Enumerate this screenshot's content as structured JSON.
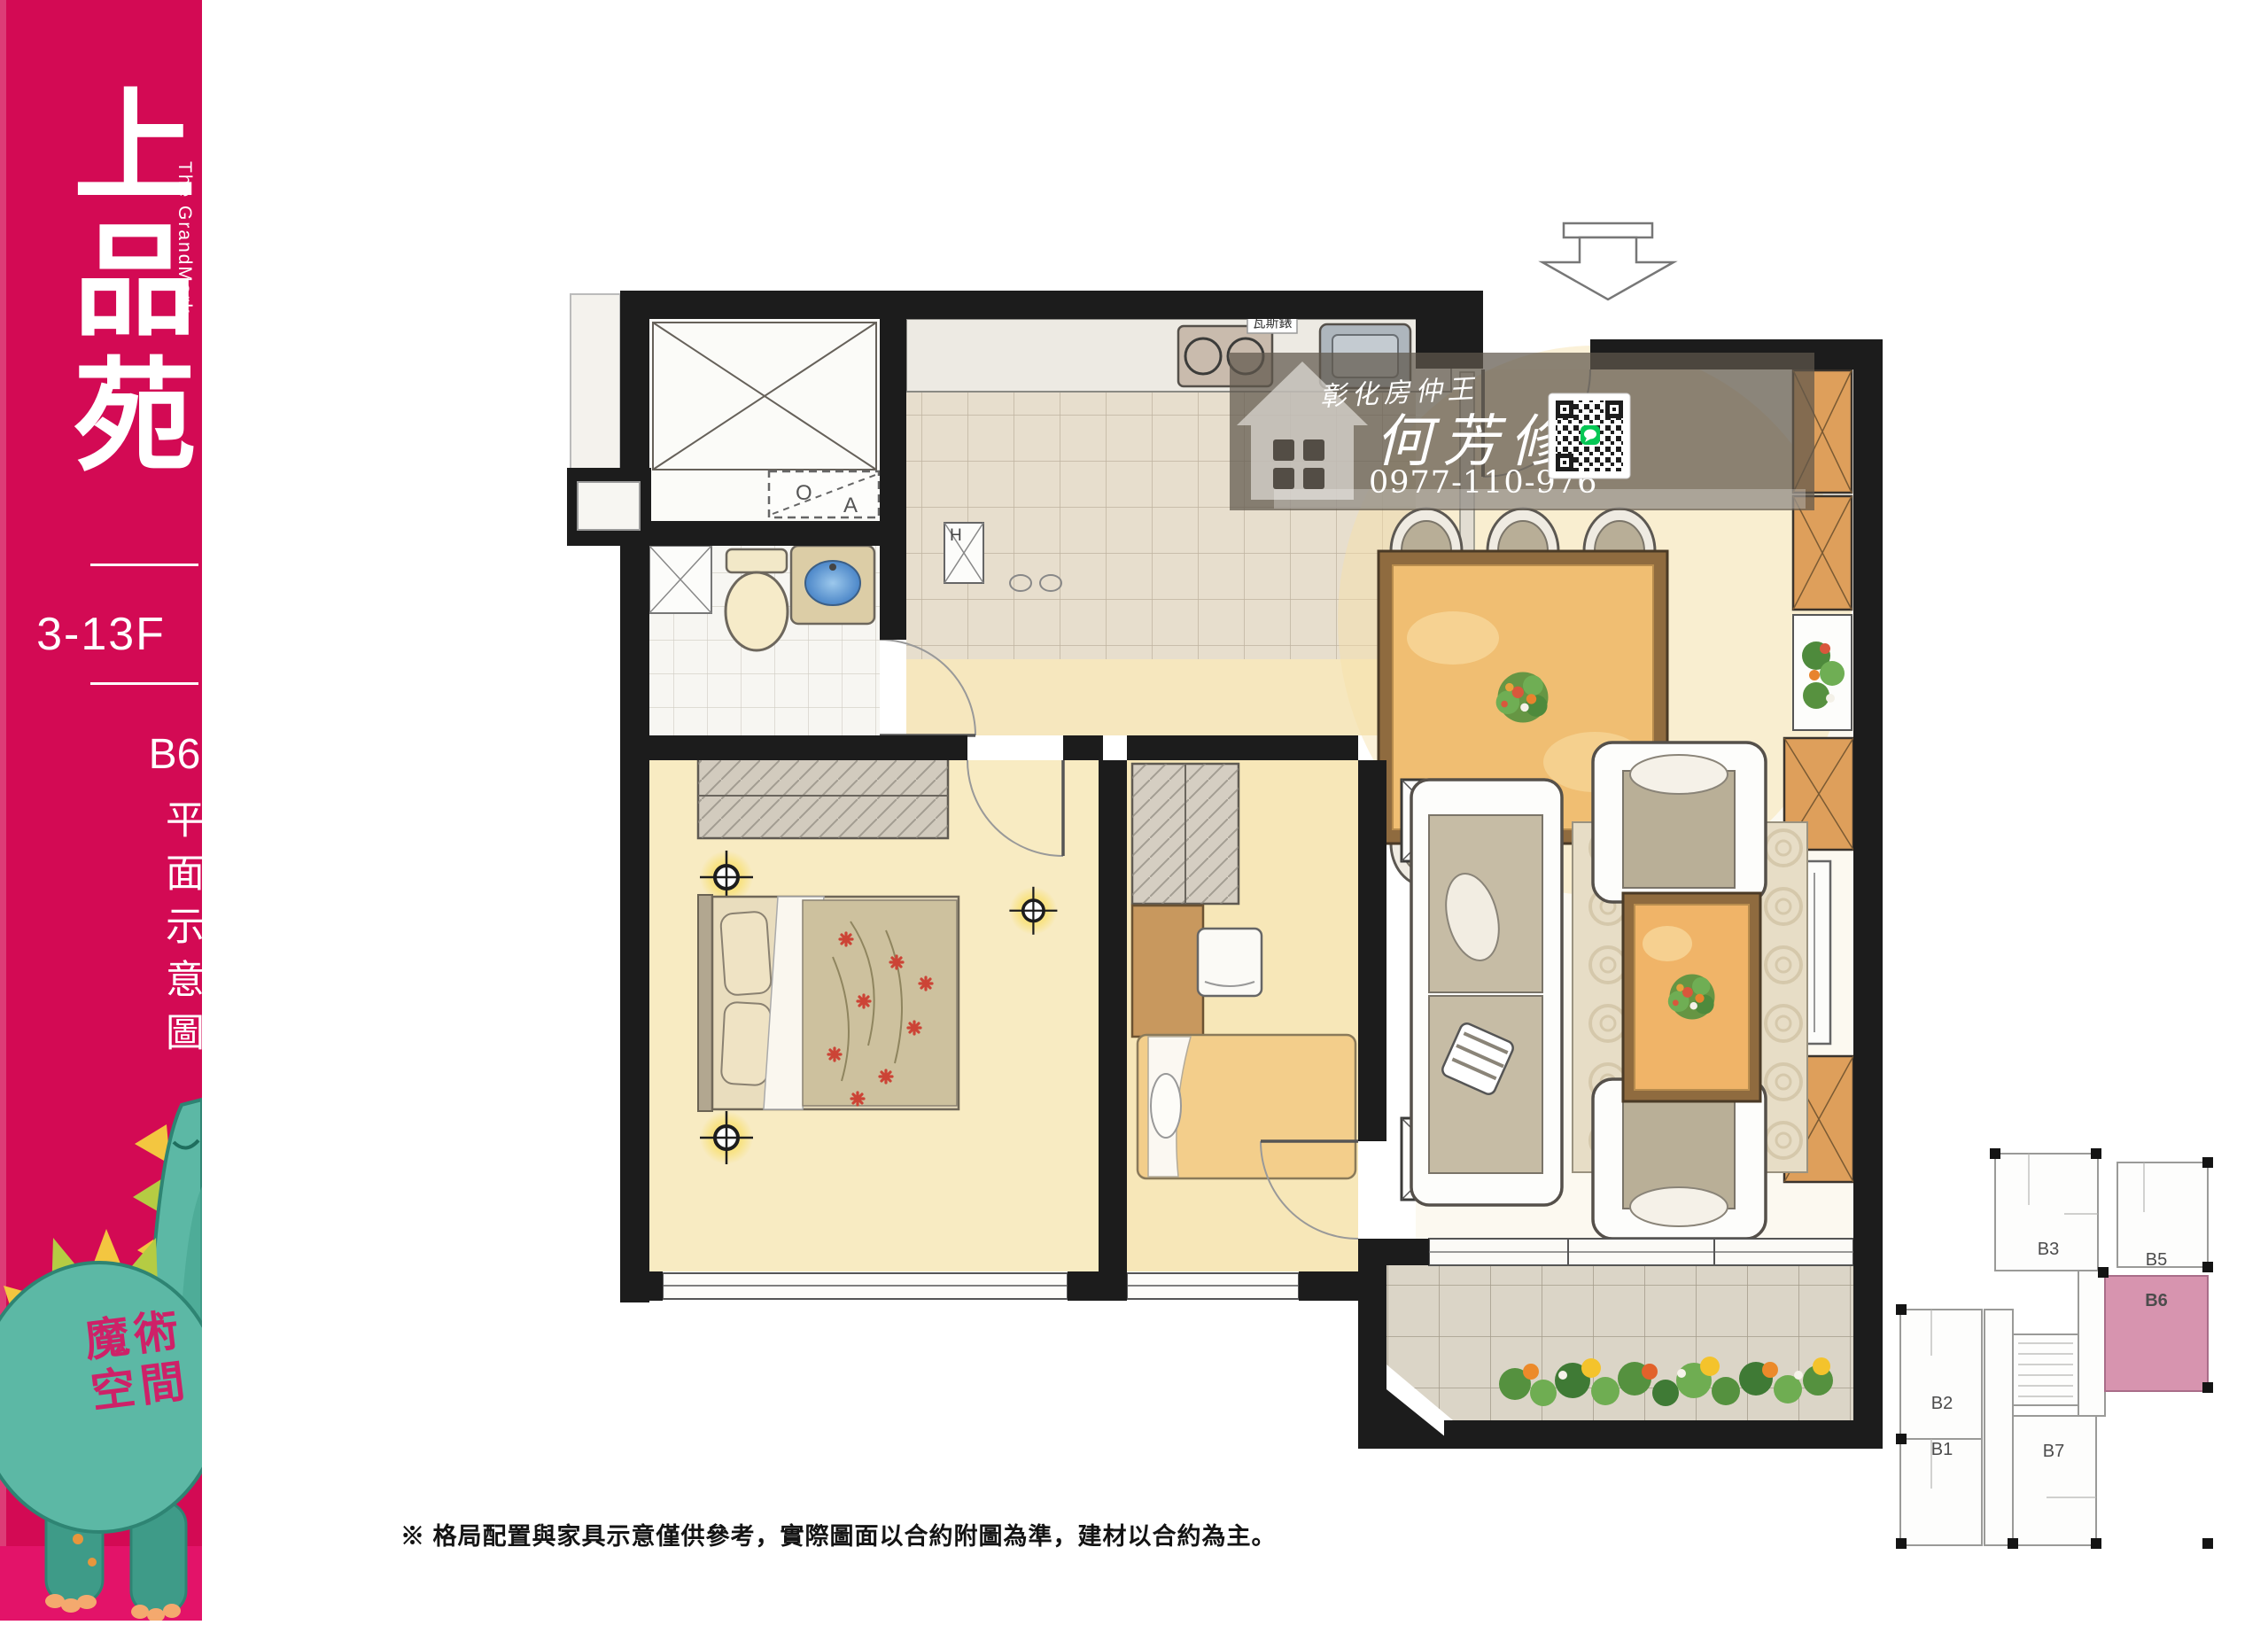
{
  "sidebar": {
    "bg_color": "#d30a54",
    "project_name": "上品苑",
    "project_name_en": "The GrandMark",
    "floor_range": "3-13F",
    "unit_label": "B6",
    "drawing_type": "平面示意圖",
    "mascot": {
      "line1": "魔術",
      "line2": "空間",
      "body_color": "#5cb8a5",
      "text_color": "#ce2168"
    }
  },
  "watermark": {
    "agency": "彰化房仲王",
    "agent": "何芳修",
    "phone": "0977-110-976"
  },
  "plan_labels": {
    "gas_meter": "瓦斯錶",
    "water_heater": "H",
    "washer_o": "O",
    "washer_a": "A"
  },
  "key_plan": {
    "highlight_unit": "B6",
    "highlight_color": "#d794af",
    "units": [
      {
        "label": "B1"
      },
      {
        "label": "B2"
      },
      {
        "label": "B3"
      },
      {
        "label": "B5"
      },
      {
        "label": "B6"
      },
      {
        "label": "B7"
      }
    ]
  },
  "footer": {
    "disclaimer": "※ 格局配置與家具示意僅供參考，實際圖面以合約附圖為準，建材以合約為主。"
  }
}
